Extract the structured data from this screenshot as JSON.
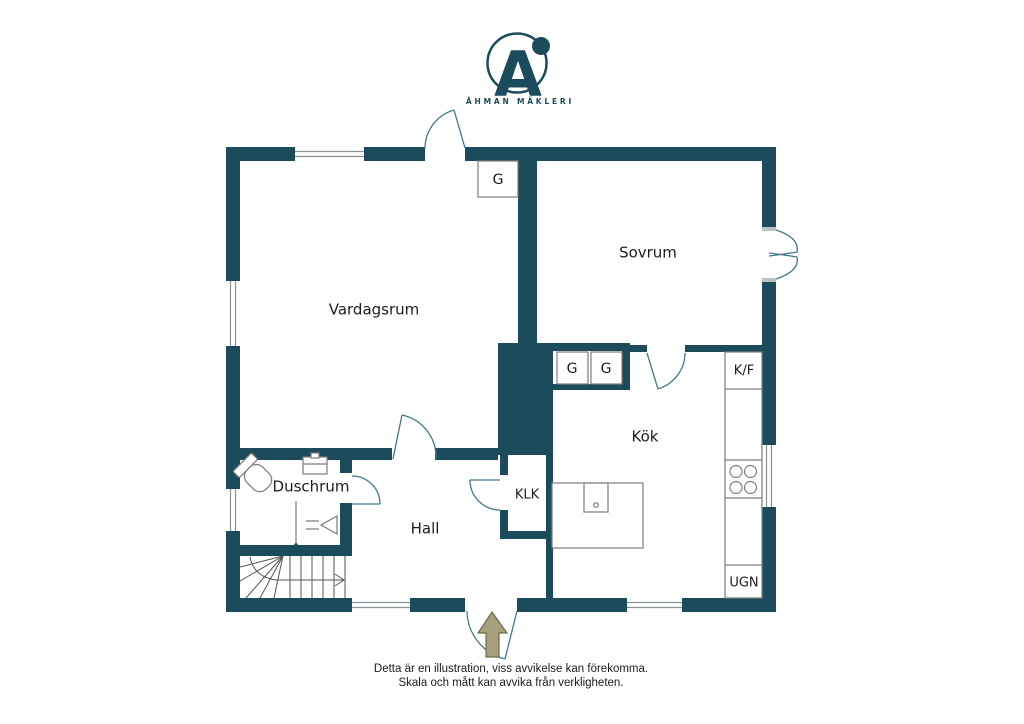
{
  "logo": {
    "monogram": "A",
    "brand": "ÅHMAN MÄKLERI"
  },
  "rooms": {
    "vardagsrum": "Vardagsrum",
    "sovrum": "Sovrum",
    "kok": "Kök",
    "hall": "Hall",
    "duschrum": "Duschrum",
    "klk": "KLK"
  },
  "fixtures": {
    "wardrobe_label": "G",
    "fridge_freezer_label": "K/F",
    "oven_label": "UGN"
  },
  "footer": {
    "line1": "Detta är en illustration, viss avvikelse kan förekomma.",
    "line2": "Skala och mått kan avvika från verkligheten."
  },
  "theme": {
    "wall_color": "#1c4c5c",
    "door_line_color": "#44788c",
    "fixture_line_color": "#7c7c7c",
    "window_line_color": "#8a9194",
    "stairs_line_color": "#555555",
    "sill_color": "#b9c2c4",
    "arrow_fill": "#a89f7c",
    "arrow_stroke": "#6e6950",
    "text_color": "#1c1c1c",
    "brand_color": "#1c4c5c",
    "bg_color": "#ffffff"
  }
}
